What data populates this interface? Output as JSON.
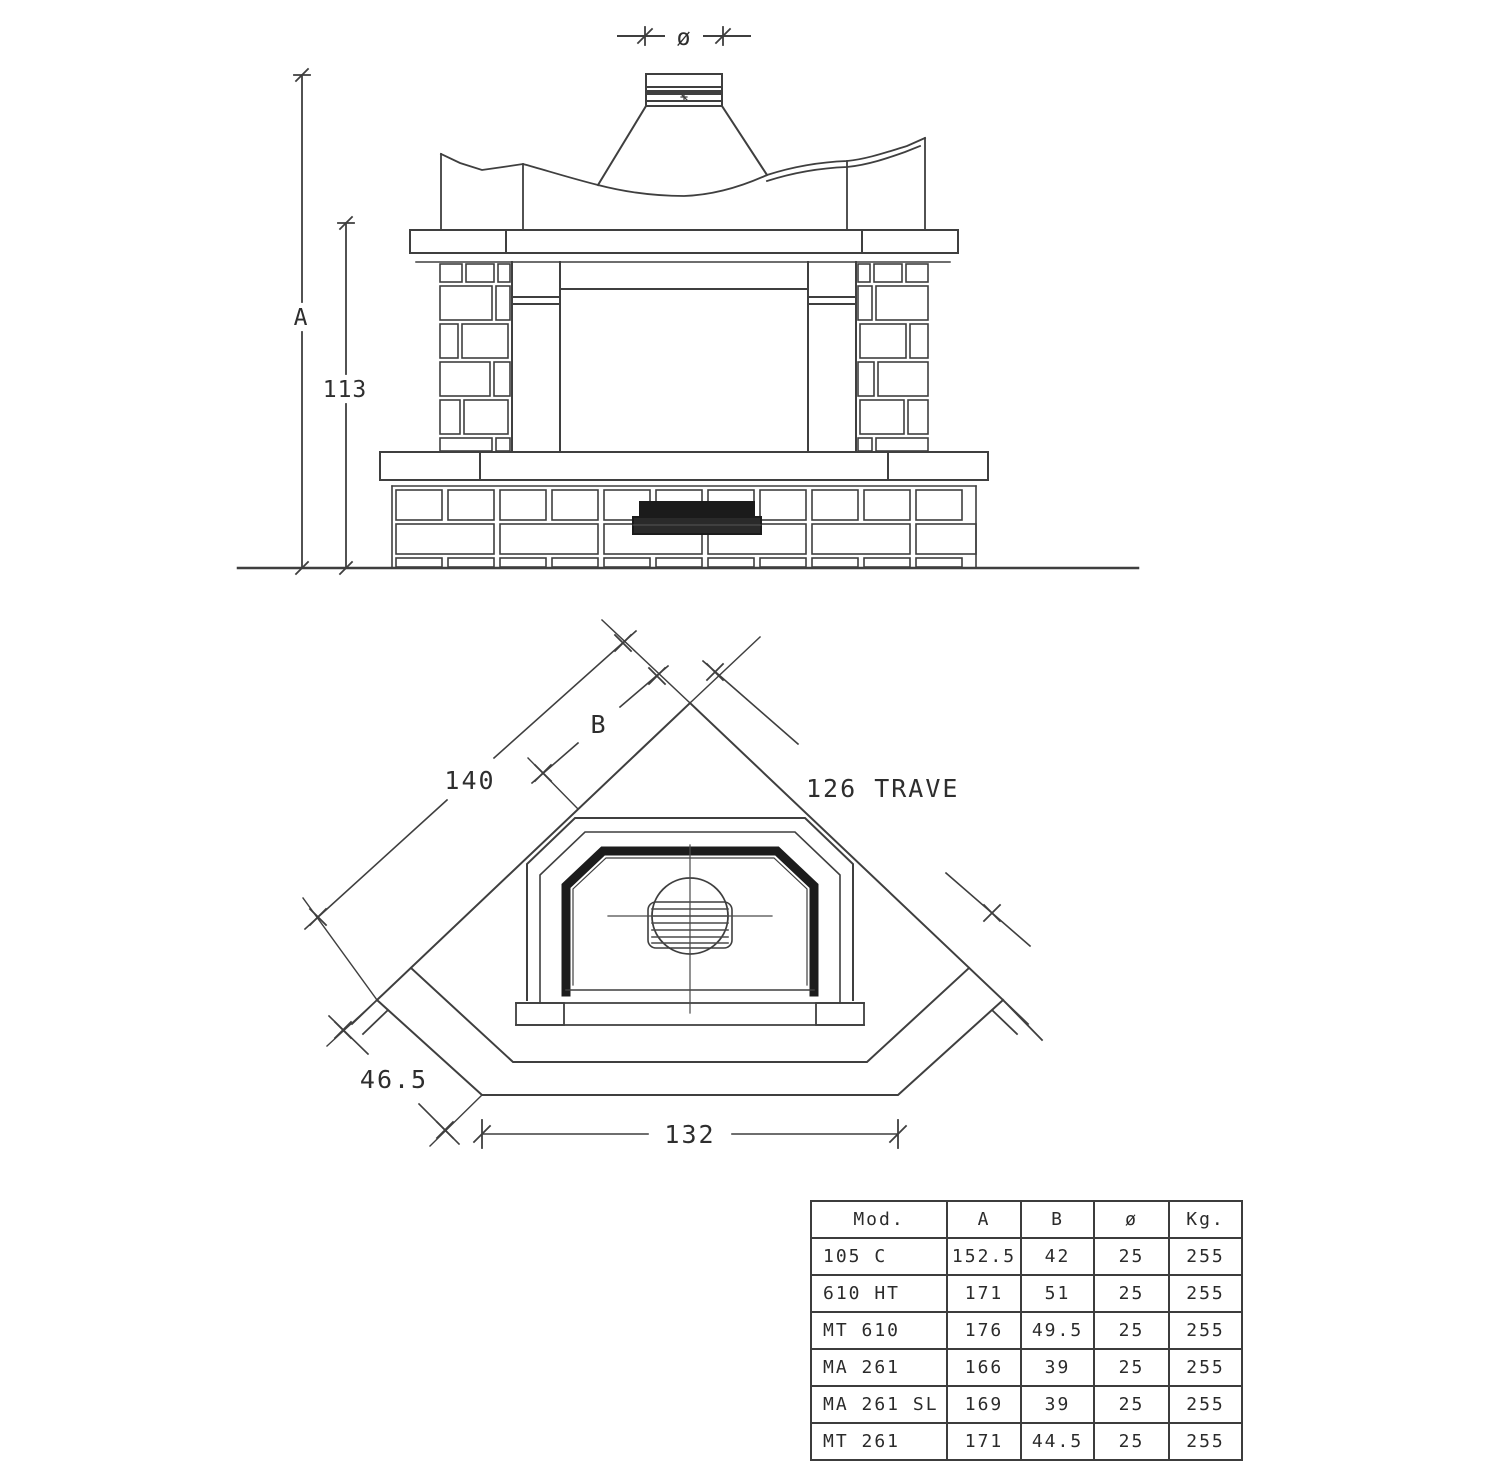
{
  "diagram": {
    "elevation": {
      "dim_flue_diameter": "ø",
      "dim_total_height": "A",
      "dim_mantel_height": "113"
    },
    "plan": {
      "dim_side_length": "140",
      "dim_beam_b": "B",
      "dim_beam_length": "126 TRAVE",
      "dim_side_depth": "46.5",
      "dim_front_width": "132"
    }
  },
  "table": {
    "headers": [
      "Mod.",
      "A",
      "B",
      "ø",
      "Kg."
    ],
    "rows": [
      [
        "105 C",
        "152.5",
        "42",
        "25",
        "255"
      ],
      [
        "610 HT",
        "171",
        "51",
        "25",
        "255"
      ],
      [
        "MT 610",
        "176",
        "49.5",
        "25",
        "255"
      ],
      [
        "MA 261",
        "166",
        "39",
        "25",
        "255"
      ],
      [
        "MA 261 SL",
        "169",
        "39",
        "25",
        "255"
      ],
      [
        "MT 261",
        "171",
        "44.5",
        "25",
        "255"
      ]
    ]
  },
  "colors": {
    "line": "#3f3f3f",
    "dark_fill": "#1b1b1b",
    "text": "#2e2e2e",
    "background": "#ffffff"
  }
}
